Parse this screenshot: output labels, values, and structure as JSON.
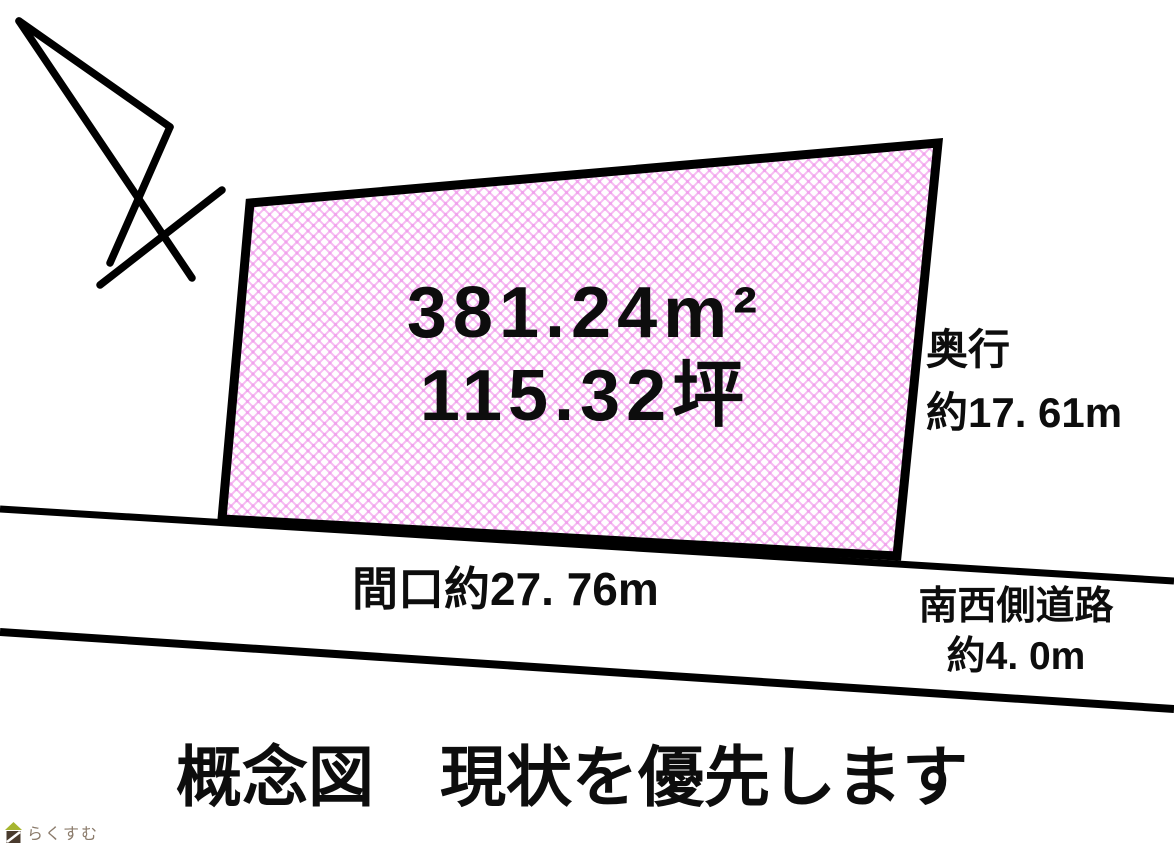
{
  "canvas": {
    "width": 1174,
    "height": 850,
    "background": "#ffffff"
  },
  "colors": {
    "outline": "#000000",
    "hatch_line": "#f6bbf2",
    "hatch_dot": "#f0a2ec",
    "text": "#0d0d0d"
  },
  "parcel": {
    "area_m2": "381.24m²",
    "area_tsubo": "115.32坪"
  },
  "measurements": {
    "depth_label": "奥行",
    "depth_value": "約17. 61m",
    "frontage": "間口約27. 76m",
    "road_name": "南西側道路",
    "road_width": "約4. 0m"
  },
  "caption": "概念図　現状を優先します",
  "icons": {
    "north_arrow": "north-arrow-icon",
    "watermark_house": "house-icon"
  },
  "watermark": {
    "text": "らくすむ",
    "roof_color": "#a6b52f",
    "body_color": "#4a3b2e",
    "stripe_color": "#ffffff",
    "text_color": "#8b7b6b"
  }
}
